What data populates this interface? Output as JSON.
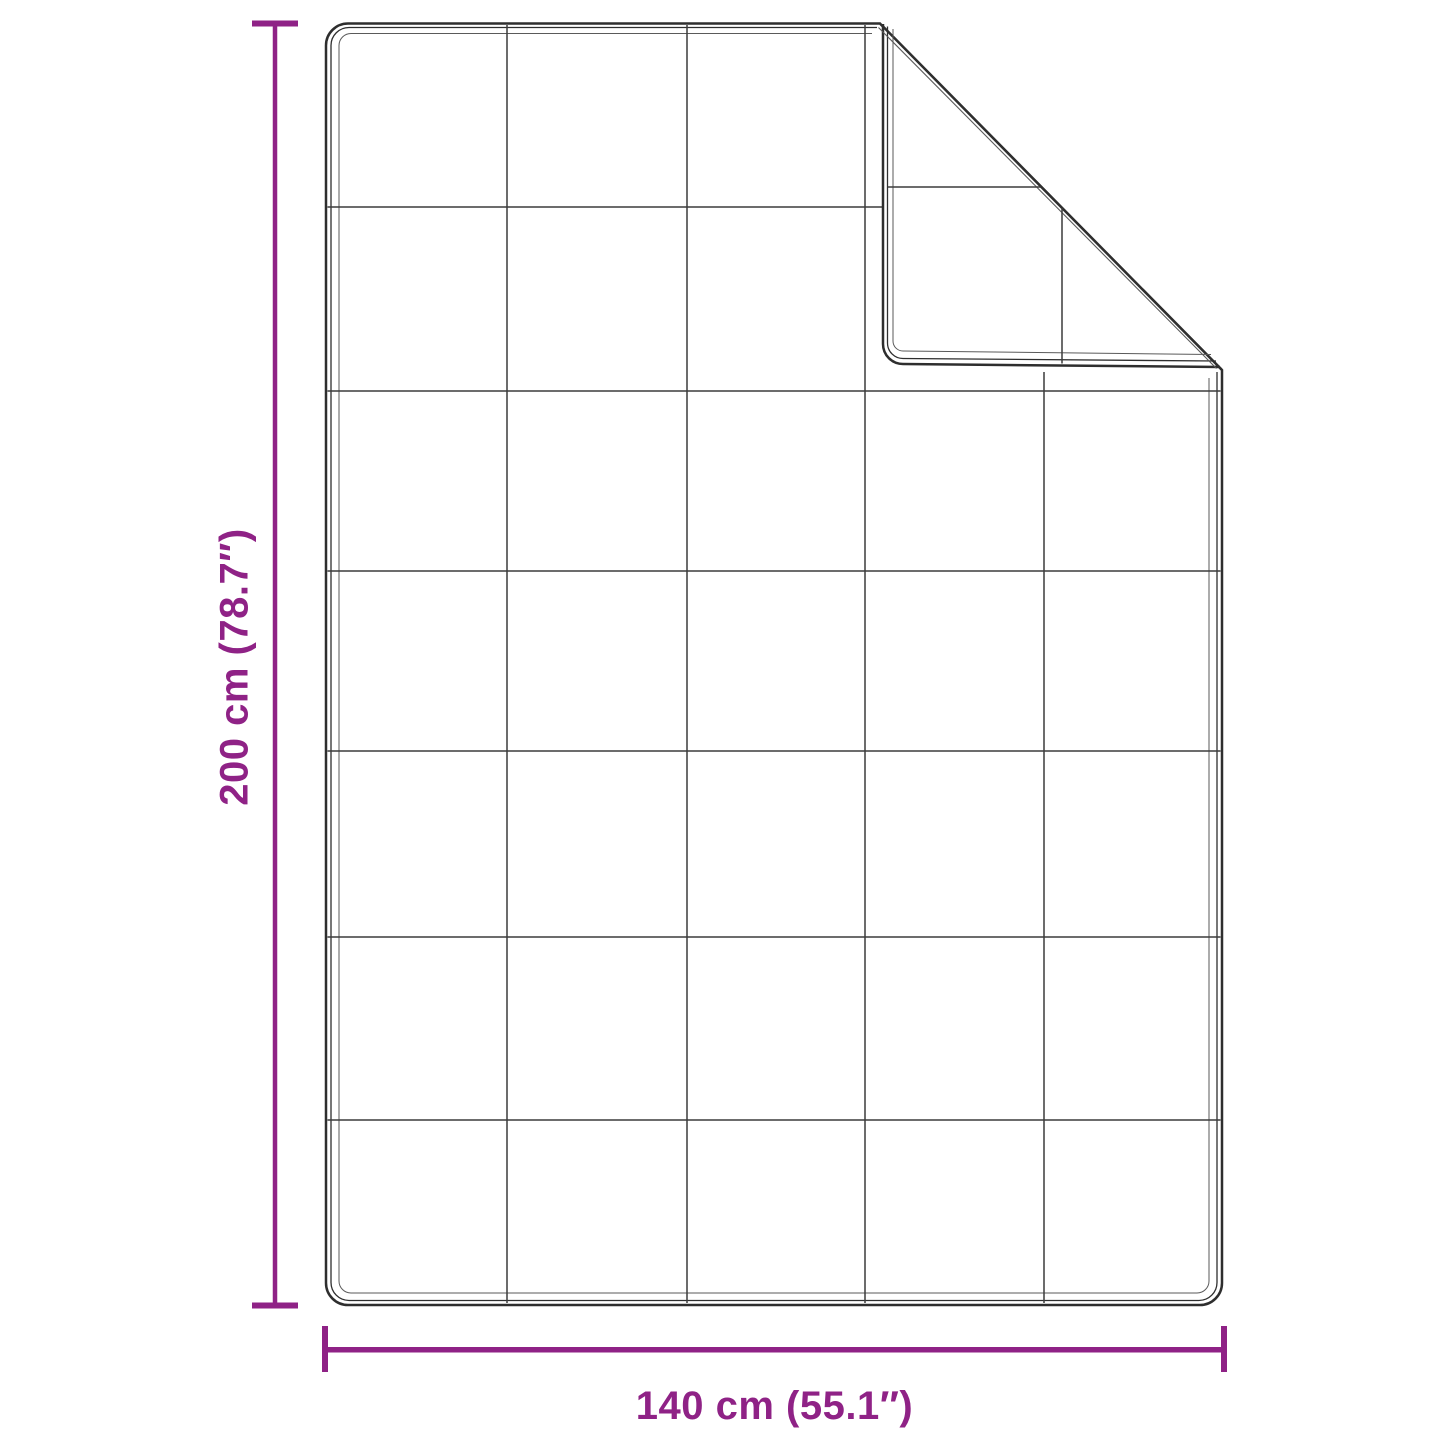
{
  "diagram": {
    "kind": "blanket-dimension-diagram",
    "width_label": "140 cm (55.1″)",
    "height_label": "200 cm (78.7″)",
    "width_cm": 140,
    "height_cm": 200,
    "width_inches": 55.1,
    "height_inches": 78.7,
    "grid_columns": 5,
    "grid_rows": 7,
    "accent_color": "#8F2286",
    "outline_color": "#2e2e2e",
    "grid_color": "#3c3c3c",
    "stitch_color": "#5a5a5a",
    "background_color": "#ffffff"
  }
}
